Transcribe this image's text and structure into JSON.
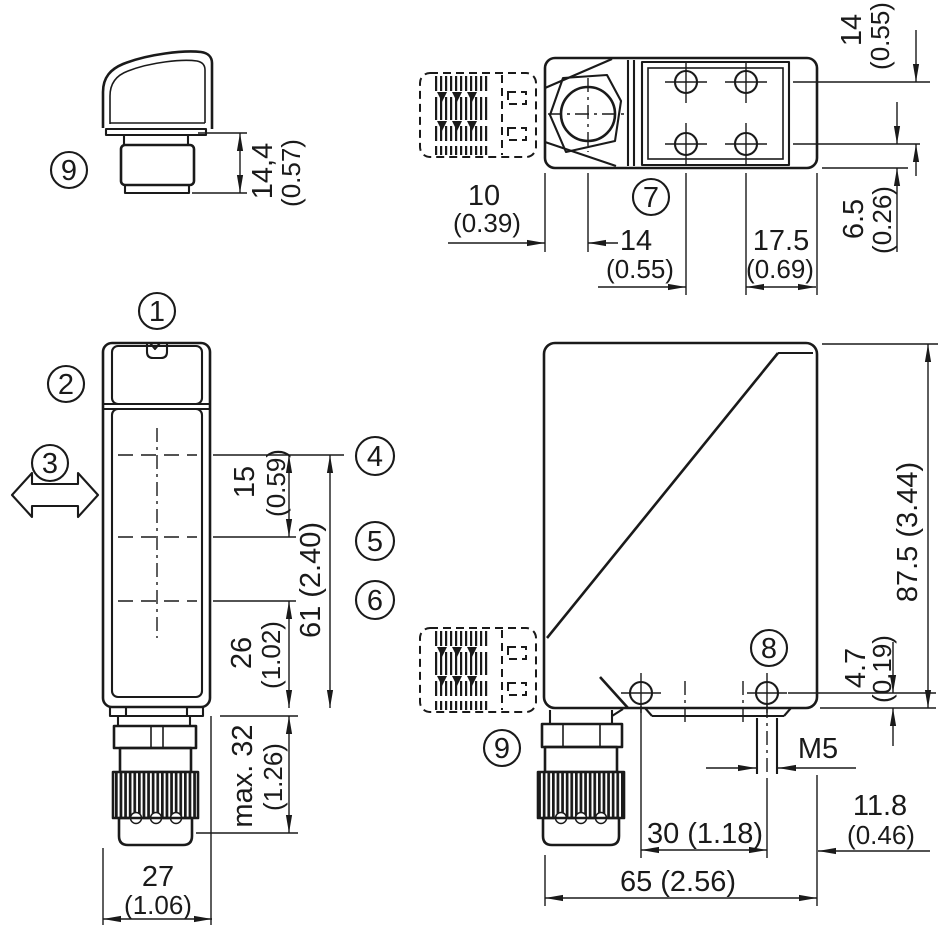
{
  "callouts": {
    "c1": "1",
    "c2": "2",
    "c3": "3",
    "c4": "4",
    "c5": "5",
    "c6": "6",
    "c7": "7",
    "c8": "8",
    "c9": "9"
  },
  "views": {
    "connector_detail": {
      "height_mm": "14,4",
      "height_in": "(0.57)"
    },
    "top_view": {
      "offset_mm": "10",
      "offset_in": "(0.39)",
      "hole_pitch_mm": "14",
      "hole_pitch_in": "(0.55)",
      "edge_dist_mm": "17.5",
      "edge_dist_in": "(0.69)",
      "row_pitch_mm": "14",
      "row_pitch_in": "(0.55)",
      "row_edge_mm": "6.5",
      "row_edge_in": "(0.26)"
    },
    "front_view": {
      "axis_gap_mm": "15",
      "axis_gap_in": "(0.59)",
      "optics_span": "61 (2.40)",
      "lower_axis_mm": "26",
      "lower_axis_in": "(1.02)",
      "connector_len_mm": "max. 32",
      "connector_len_in": "(1.26)",
      "width_mm": "27",
      "width_in": "(1.06)"
    },
    "side_view": {
      "height": "87.5 (3.44)",
      "hole_edge_mm": "4.7",
      "hole_edge_in": "(0.19)",
      "thread": "M5",
      "hole_pitch": "30 (1.18)",
      "thread_edge_mm": "11.8",
      "thread_edge_in": "(0.46)",
      "depth": "65 (2.56)"
    }
  }
}
